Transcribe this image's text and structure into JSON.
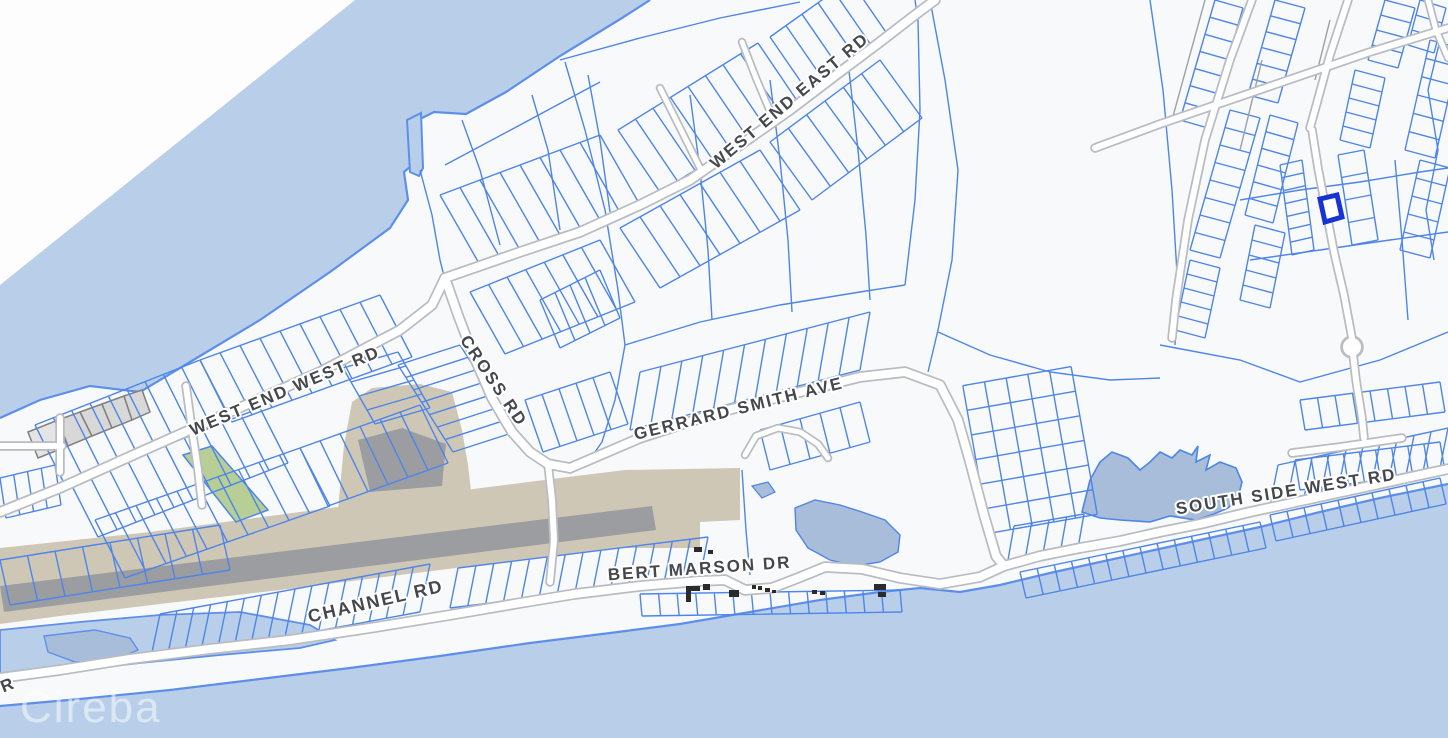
{
  "map": {
    "watermark": "Cireba",
    "road_labels": [
      {
        "id": "west-end-east-rd",
        "label": "WEST END EAST RD"
      },
      {
        "id": "west-end-west-rd",
        "label": "WEST END WEST RD"
      },
      {
        "id": "cross-rd",
        "label": "CROSS RD"
      },
      {
        "id": "gerrard-smith-ave",
        "label": "GERRARD SMITH AVE"
      },
      {
        "id": "south-side-west-rd",
        "label": "SOUTH SIDE WEST RD"
      },
      {
        "id": "bert-marson-dr",
        "label": "BERT MARSON DR"
      },
      {
        "id": "channel-rd",
        "label": "CHANNEL RD"
      },
      {
        "id": "partial-road-label",
        "label": "R"
      }
    ],
    "selected_parcel": {
      "highlighted": true
    },
    "colors": {
      "sea": "#b9cfe9",
      "land": "#f8f9fb",
      "offmap": "#fdfdfe",
      "coast": "#5d8fea",
      "parcel": "#4d85e8",
      "parcel-gray": "#9aa0a6",
      "road-casing": "#b9bcc1",
      "road-fill": "#ffffff",
      "tan": "#cfc7b6",
      "runway": "#9c9da0",
      "green": "#b7cf97",
      "gray-parcel": "#d8d8d8",
      "building": "#2b2b2b",
      "label": "#44474c",
      "select": "#1733d6",
      "pond": "#a7bdd9"
    }
  }
}
